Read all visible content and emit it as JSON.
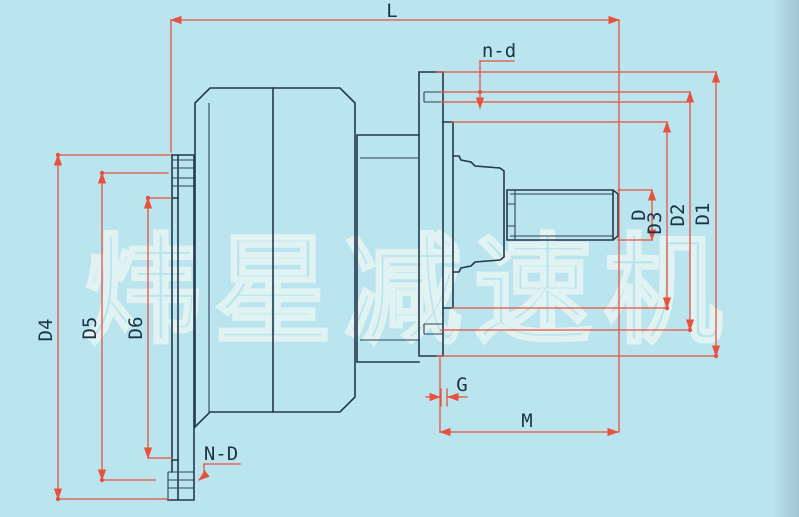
{
  "watermark": {
    "text": "炜星减速机"
  },
  "dims": {
    "l": "L",
    "n_d": "n-d",
    "d": "D",
    "d3": "D3",
    "d2": "D2",
    "d1": "D1",
    "d4": "D4",
    "d5": "D5",
    "d6": "D6",
    "g": "G",
    "m": "M",
    "n_d_caps": "N-D"
  },
  "colors": {
    "background": "#bae5ef",
    "outline": "#24384a",
    "dimension_lines": "#e8513c",
    "labels": "#1d3347",
    "watermark_outline": "#e7f5f3"
  }
}
